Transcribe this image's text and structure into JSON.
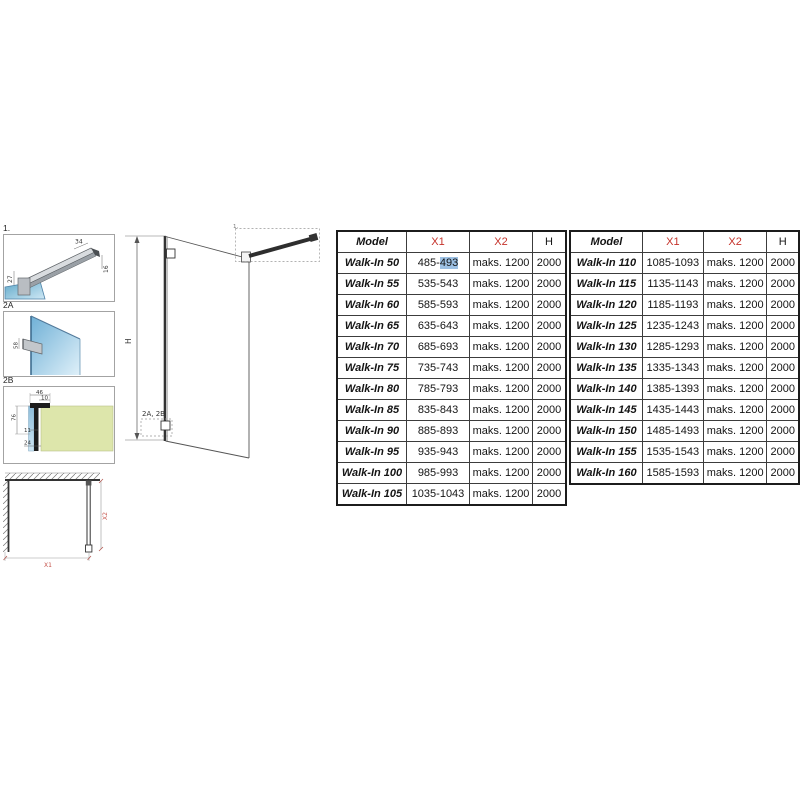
{
  "drawings": {
    "detail1": {
      "label": "1.",
      "dim_bar_width": "34",
      "dim_bar_height": "16",
      "dim_offset": "27"
    },
    "detail2a": {
      "label": "2A",
      "dim_bracket": "58"
    },
    "detail2b": {
      "label": "2B",
      "dim_profile_width": "46",
      "dim_inner": "10",
      "dim_profile_height": "76",
      "dim_glass": "11",
      "dim_bottom": "24"
    },
    "elevation": {
      "height_label": "H",
      "callout_top": "1.",
      "callout_bottom": "2A, 2B"
    },
    "plan": {
      "width_label": "X1",
      "depth_label": "X2"
    }
  },
  "tables": [
    {
      "headers": [
        {
          "label": "Model",
          "red": false
        },
        {
          "label": "X1",
          "red": true
        },
        {
          "label": "X2",
          "red": true
        },
        {
          "label": "H",
          "red": false
        }
      ],
      "rows": [
        {
          "model": "Walk-In 50",
          "x1": "485-493",
          "x1_highlight": "493",
          "x2": "maks. 1200",
          "h": "2000"
        },
        {
          "model": "Walk-In 55",
          "x1": "535-543",
          "x2": "maks. 1200",
          "h": "2000"
        },
        {
          "model": "Walk-In 60",
          "x1": "585-593",
          "x2": "maks. 1200",
          "h": "2000"
        },
        {
          "model": "Walk-In 65",
          "x1": "635-643",
          "x2": "maks. 1200",
          "h": "2000"
        },
        {
          "model": "Walk-In 70",
          "x1": "685-693",
          "x2": "maks. 1200",
          "h": "2000"
        },
        {
          "model": "Walk-In 75",
          "x1": "735-743",
          "x2": "maks. 1200",
          "h": "2000"
        },
        {
          "model": "Walk-In 80",
          "x1": "785-793",
          "x2": "maks. 1200",
          "h": "2000"
        },
        {
          "model": "Walk-In 85",
          "x1": "835-843",
          "x2": "maks. 1200",
          "h": "2000"
        },
        {
          "model": "Walk-In 90",
          "x1": "885-893",
          "x2": "maks. 1200",
          "h": "2000"
        },
        {
          "model": "Walk-In 95",
          "x1": "935-943",
          "x2": "maks. 1200",
          "h": "2000"
        },
        {
          "model": "Walk-In 100",
          "x1": "985-993",
          "x2": "maks. 1200",
          "h": "2000"
        },
        {
          "model": "Walk-In 105",
          "x1": "1035-1043",
          "x2": "maks. 1200",
          "h": "2000"
        }
      ]
    },
    {
      "headers": [
        {
          "label": "Model",
          "red": false
        },
        {
          "label": "X1",
          "red": true
        },
        {
          "label": "X2",
          "red": true
        },
        {
          "label": "H",
          "red": false
        }
      ],
      "rows": [
        {
          "model": "Walk-In 110",
          "x1": "1085-1093",
          "x2": "maks. 1200",
          "h": "2000"
        },
        {
          "model": "Walk-In 115",
          "x1": "1135-1143",
          "x2": "maks. 1200",
          "h": "2000"
        },
        {
          "model": "Walk-In 120",
          "x1": "1185-1193",
          "x2": "maks. 1200",
          "h": "2000"
        },
        {
          "model": "Walk-In 125",
          "x1": "1235-1243",
          "x2": "maks. 1200",
          "h": "2000"
        },
        {
          "model": "Walk-In 130",
          "x1": "1285-1293",
          "x2": "maks. 1200",
          "h": "2000"
        },
        {
          "model": "Walk-In 135",
          "x1": "1335-1343",
          "x2": "maks. 1200",
          "h": "2000"
        },
        {
          "model": "Walk-In 140",
          "x1": "1385-1393",
          "x2": "maks. 1200",
          "h": "2000"
        },
        {
          "model": "Walk-In 145",
          "x1": "1435-1443",
          "x2": "maks. 1200",
          "h": "2000"
        },
        {
          "model": "Walk-In 150",
          "x1": "1485-1493",
          "x2": "maks. 1200",
          "h": "2000"
        },
        {
          "model": "Walk-In 155",
          "x1": "1535-1543",
          "x2": "maks. 1200",
          "h": "2000"
        },
        {
          "model": "Walk-In 160",
          "x1": "1585-1593",
          "x2": "maks. 1200",
          "h": "2000"
        }
      ]
    }
  ],
  "colors": {
    "accent_red": "#c5332b",
    "highlight_blue": "#9dc1e4",
    "glass_blue": "#7fb6d9",
    "wall_green": "#dde6ad"
  }
}
